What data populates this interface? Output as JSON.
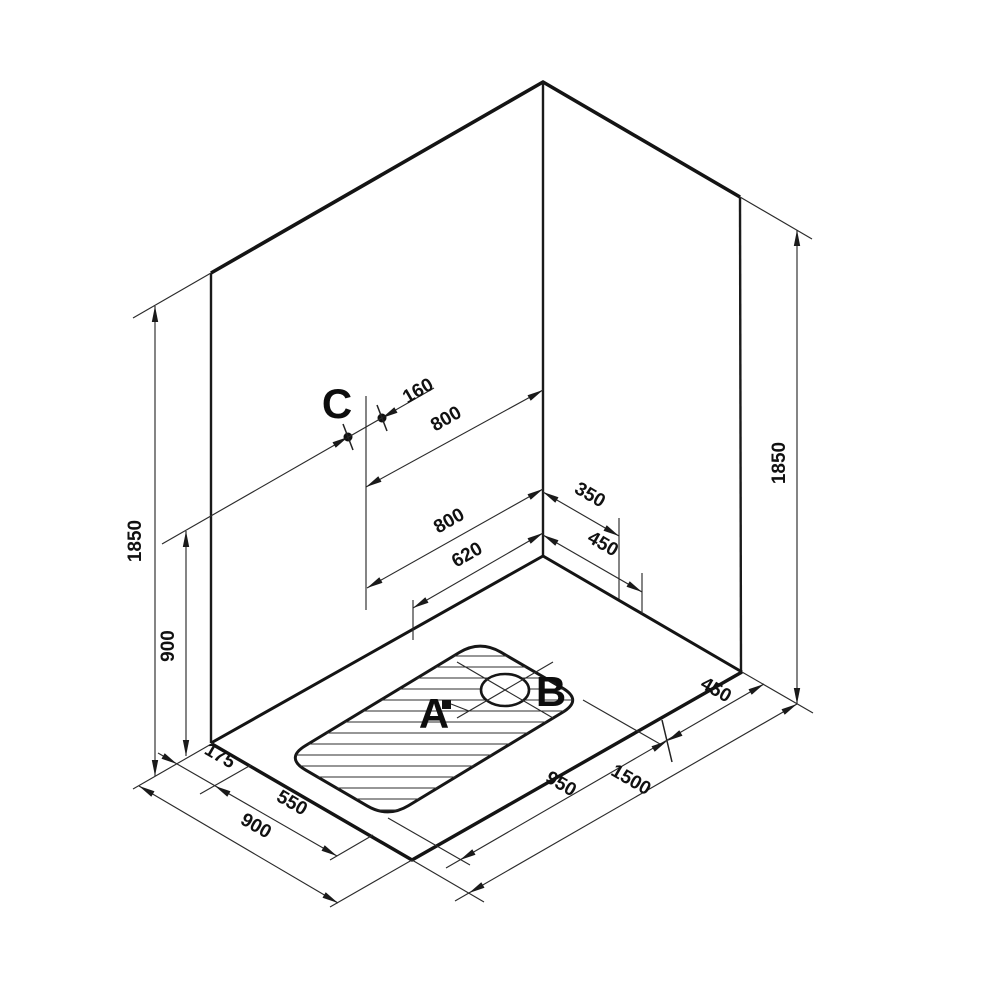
{
  "drawing": {
    "type": "isometric-installation-diagram",
    "background": "#ffffff",
    "line_color": "#1a1a1a",
    "points": {
      "a": "A",
      "b": "B",
      "c": "C"
    },
    "dimensions": {
      "height_left": "1850",
      "height_c": "900",
      "height_right": "1850",
      "c_spacing": "160",
      "c_offset_upper": "800",
      "c_offset_lower": "800",
      "drain_offset": "620",
      "wall_right_near": "350",
      "wall_right_far": "450",
      "floor_left_margin": "175",
      "tray_width": "550",
      "floor_left_total": "900",
      "tray_length": "950",
      "floor_right_total": "1500",
      "floor_right_margin": "450"
    }
  }
}
